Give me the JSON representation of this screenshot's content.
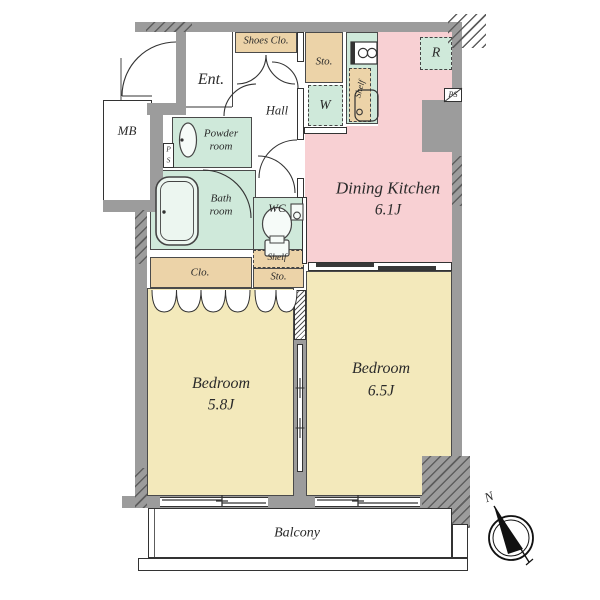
{
  "title": "Apartment floor plan",
  "colors": {
    "wall_gray": "#9c9c9c",
    "closet_tan": "#ecd3a8",
    "wet_area_green": "#cfe9da",
    "dining_kitchen_pink": "#f8d0d3",
    "bedroom_yellow": "#f3e9bb"
  },
  "labels": {
    "ent": "Ent.",
    "shoes_clo": "Shoes Clo.",
    "sto_upper": "Sto.",
    "washer": "W",
    "fridge": "R",
    "shelf_kitchen": "Shelf",
    "hall": "Hall",
    "mb": "MB",
    "ps_p": "P",
    "ps_s": "S",
    "ps_right": "PS",
    "powder_room": "Powder room",
    "bath_room": "Bath room",
    "wc": "WC",
    "shelf_wc": "Shelf",
    "clo": "Clo.",
    "sto_lower": "Sto.",
    "dining_kitchen": "Dining Kitchen",
    "dining_kitchen_size": "6.1J",
    "bedroom_small": "Bedroom",
    "bedroom_small_size": "5.8J",
    "bedroom_large": "Bedroom",
    "bedroom_large_size": "6.5J",
    "balcony": "Balcony",
    "north": "N"
  }
}
